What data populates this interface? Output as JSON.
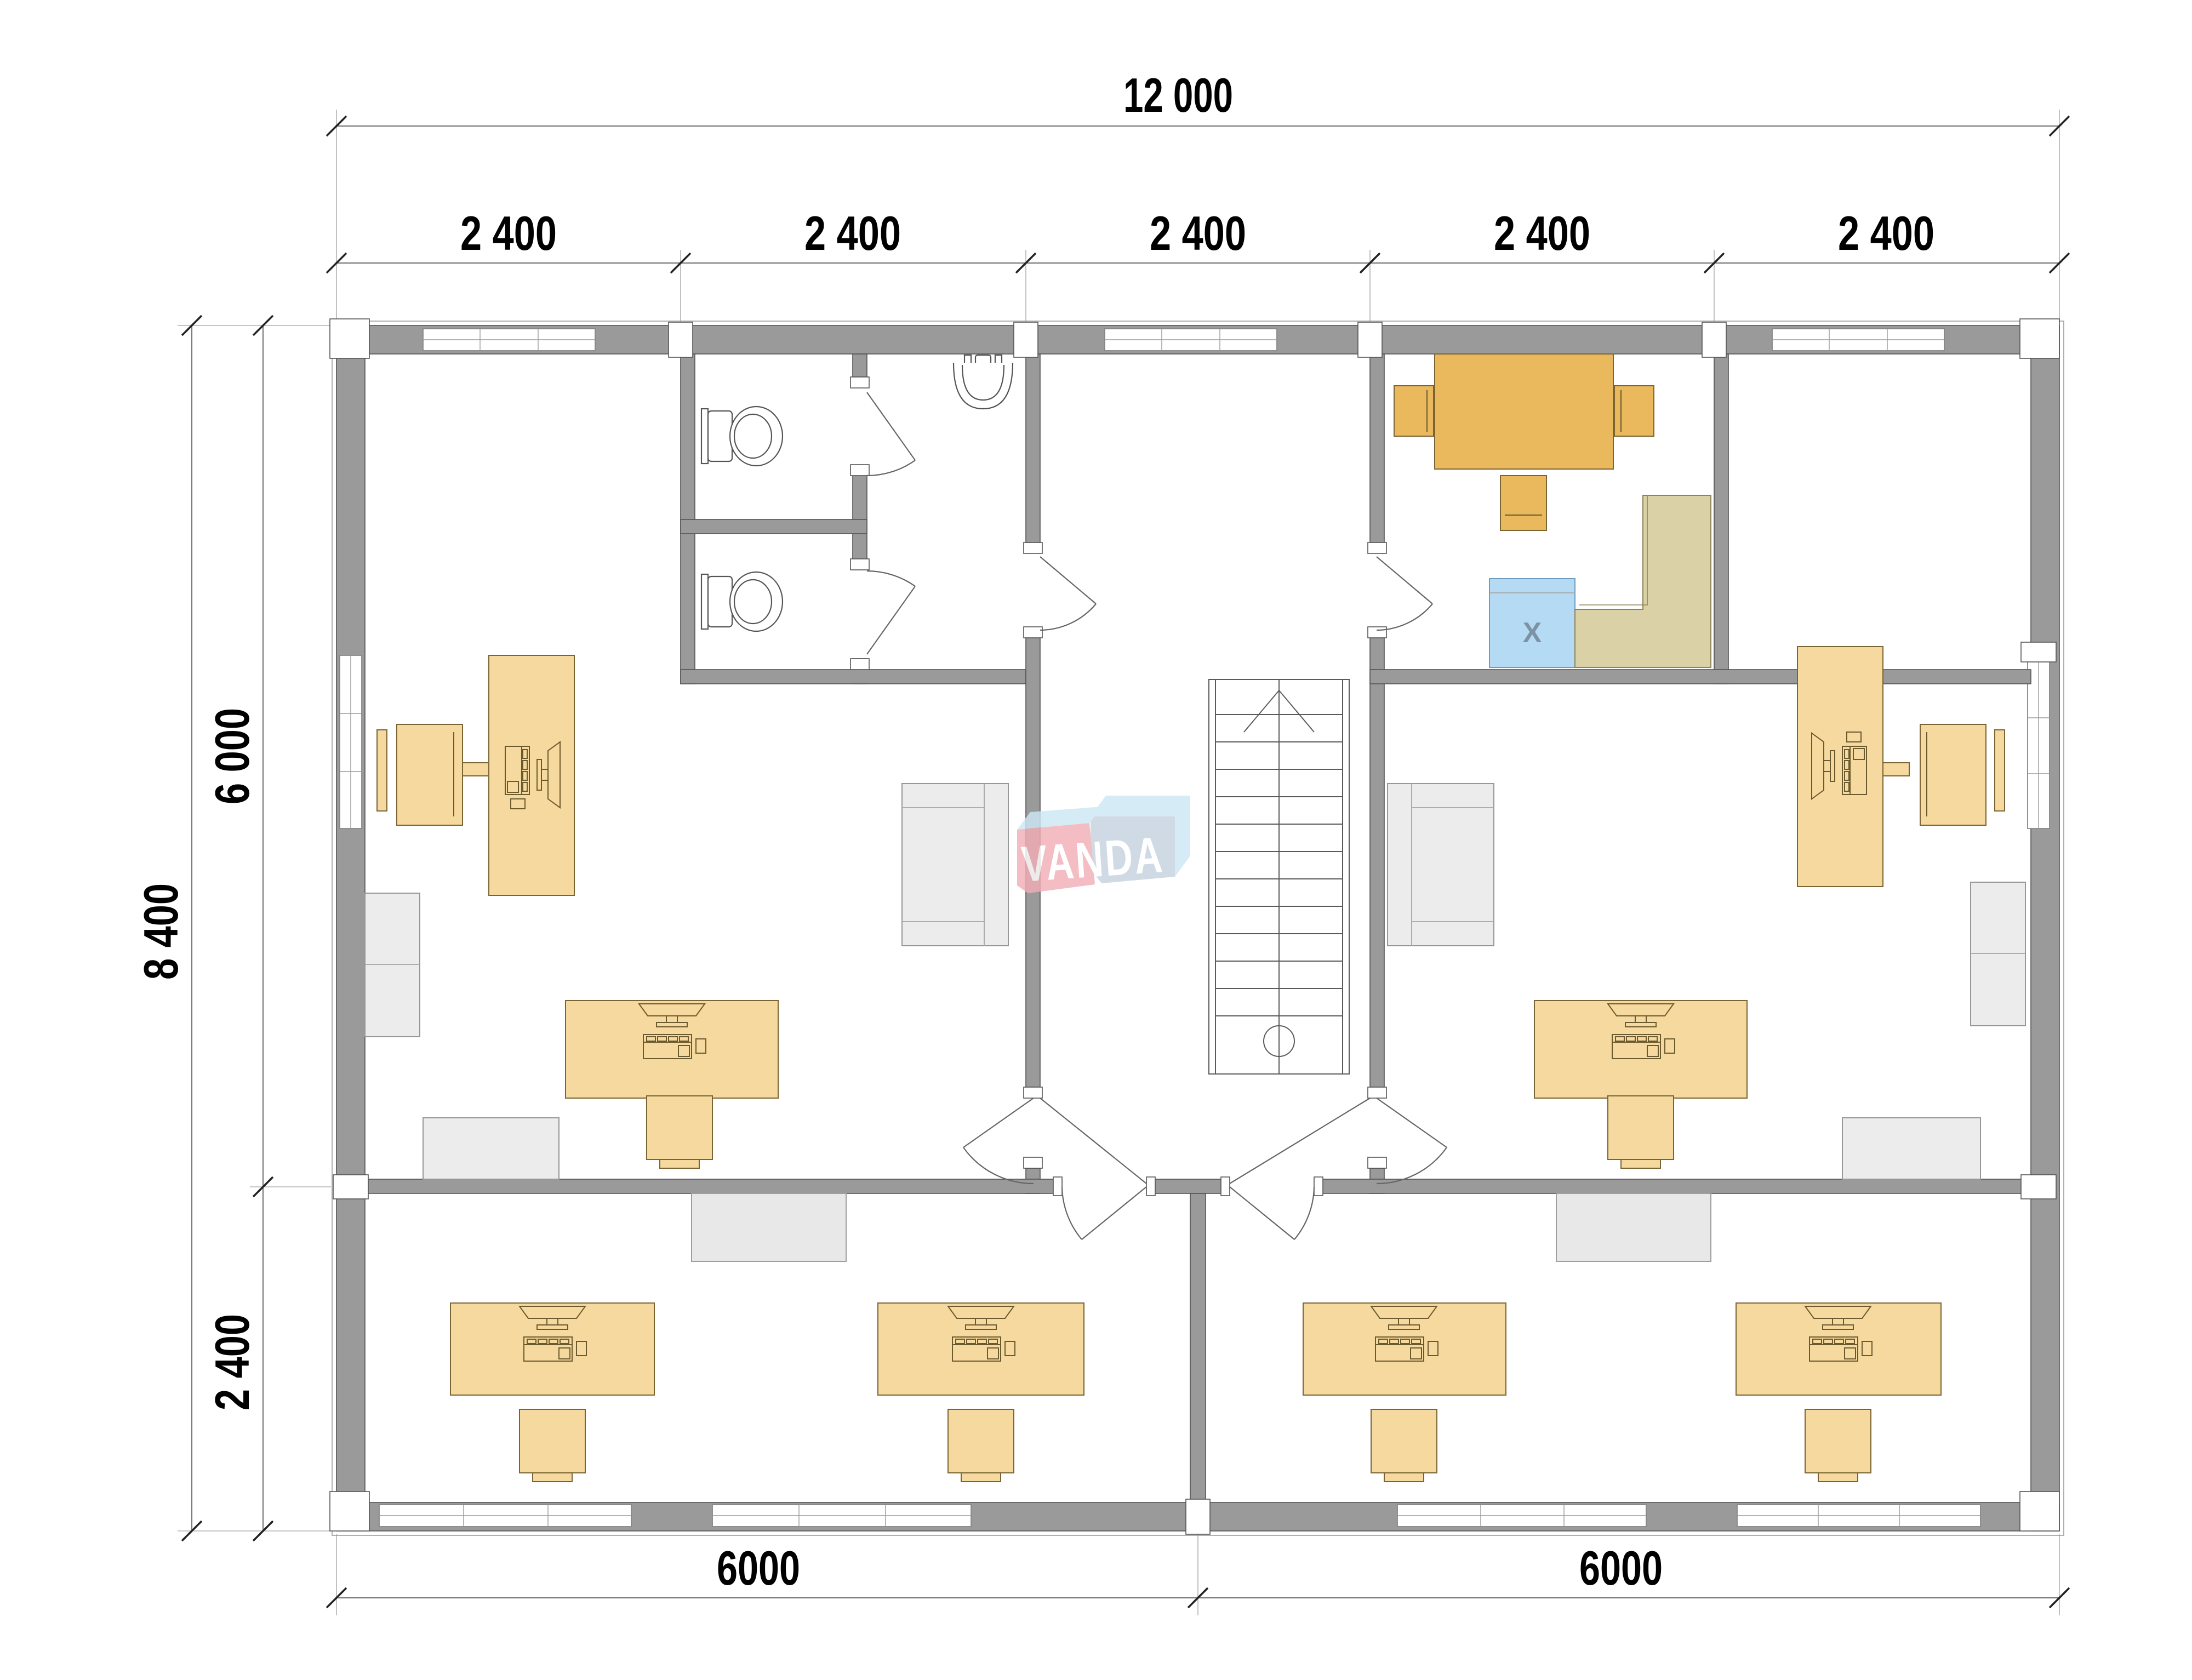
{
  "dimensions": {
    "top_total": "12 000",
    "top_segments": [
      "2 400",
      "2 400",
      "2 400",
      "2 400",
      "2 400"
    ],
    "left_total": "8 400",
    "left_upper": "6 000",
    "left_lower": "2 400",
    "bottom_left": "6000",
    "bottom_right": "6000"
  },
  "watermark": {
    "text": "VANDA"
  },
  "kitchen": {
    "appliance_label": "X"
  },
  "colors": {
    "wall": "#9A9A9A",
    "wall_edge": "#555555",
    "desk": "#F5D99E",
    "desk_edge": "#7A6434",
    "table": "#EBB95D",
    "counter": "#DBD1A6",
    "appliance": "#B5DAF4",
    "appliance_edge": "#6E9CBF",
    "furn_gray": "#ECECEC",
    "board_gray": "#E8E8E8",
    "logo_pink": "#F2AEB6",
    "logo_pink_top": "#F8D0D4",
    "logo_blue_top": "#CDE7F5",
    "logo_blue_front": "#C6D2E0"
  }
}
